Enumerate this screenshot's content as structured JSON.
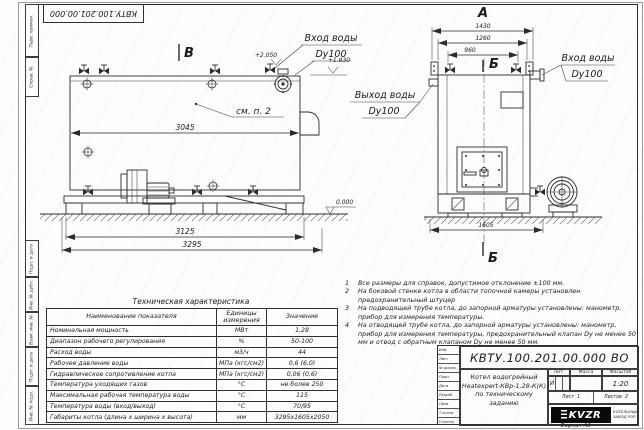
{
  "frame": {
    "doc_number_top": "КВТУ.100.201.00.000 ВО",
    "format_label": "Формат  А3",
    "margin_labels": [
      "Перв. примен.",
      "Справ. №",
      "Подп. и дата",
      "Инв. № дубл.",
      "Взам. инв. №",
      "Подп. и дата",
      "Инв. № подл."
    ]
  },
  "side_view": {
    "view_marker": "В",
    "see_note": "см. п. 2",
    "inlet_title": "Вход воды",
    "inlet_dn": "Dy100",
    "elev_high": "+2.050",
    "elev_mid": "+1.930",
    "elev_zero": "0.000",
    "dim_top": "3045",
    "dim_mid": "3125",
    "dim_out": "3295"
  },
  "front_view": {
    "view_marker": "А",
    "section_marker": "Б",
    "dim_w1": "1430",
    "dim_w2": "1260",
    "dim_w3": "960",
    "dim_base": "1605",
    "outlet_title": "Выход воды",
    "outlet_dn": "Dy100",
    "inlet_title": "Вход воды",
    "inlet_dn": "Dy100"
  },
  "notes": [
    {
      "num": "1",
      "text": "Все размеры для справок, допустимое отклонение ±100 мм."
    },
    {
      "num": "2",
      "text": "На боковой стенке котла в области топочной камеры установлен предохранительный штуцер"
    },
    {
      "num": "3",
      "text": "На  подводящей трубе котла, до запорной арматуры установлены: манометр, прибор для измерения температуры."
    },
    {
      "num": "4",
      "text": "На отводящей трубе котла, до запорной арматуры установлены: манометр, прибор для измерения температуры, предохранительный клапан Dу не менее 50 мм и отвод с обратным клапаном Dу не менее 50 мм."
    }
  ],
  "table": {
    "title": "Техническая характеристика",
    "headers": [
      "Наименование показателя",
      "Единицы измерения",
      "Значение"
    ],
    "rows": [
      [
        "Номинальная мощность",
        "МВт",
        "1,28"
      ],
      [
        "Диапазон рабочего регулирования",
        "%",
        "50-100"
      ],
      [
        "Расход воды",
        "м3/ч",
        "44"
      ],
      [
        "Рабочее давление воды",
        "МПа (кгс/см2)",
        "0,6 (6,0)"
      ],
      [
        "Гидравлическое сопротивление котла",
        "МПа (кгс/см2)",
        "0,06 (0,6)"
      ],
      [
        "Температура уходящих газов",
        "°С",
        "не более 250"
      ],
      [
        "Максимальная рабочая температура воды",
        "°С",
        "115"
      ],
      [
        "Температура воды (вход/выход)",
        "°С",
        "70/95"
      ],
      [
        "Габариты котла (длина х ширина х высота)",
        "мм",
        "3295х1605х2050"
      ]
    ]
  },
  "title_block": {
    "number": "КВТУ.100.201.00.000  ВО",
    "product_line1": "Котел водогрейный",
    "product_line2": "Heatexpert-КВр-1,28-К(К)",
    "product_line3": "по техническому заданию",
    "rev_cols": [
      "Изм.",
      "Лист",
      "№ докум.",
      "Подп.",
      "Дата"
    ],
    "roles": [
      "Разраб.",
      "Пров.",
      "Т.контр.",
      "Н.контр.",
      "Утв."
    ],
    "lit_label": "Лит.",
    "lit_value": "И",
    "mass_label": "Масса",
    "scale_label": "Масштаб",
    "scale_value": "1:20",
    "sheet_label": "Лист",
    "sheet_value": "1",
    "sheets_label": "Листов",
    "sheets_value": "2",
    "logo_text": "KVZR",
    "company_line1": "КОТЕЛЬНЫЙ",
    "company_line2": "ЗАВОД РЭП"
  }
}
